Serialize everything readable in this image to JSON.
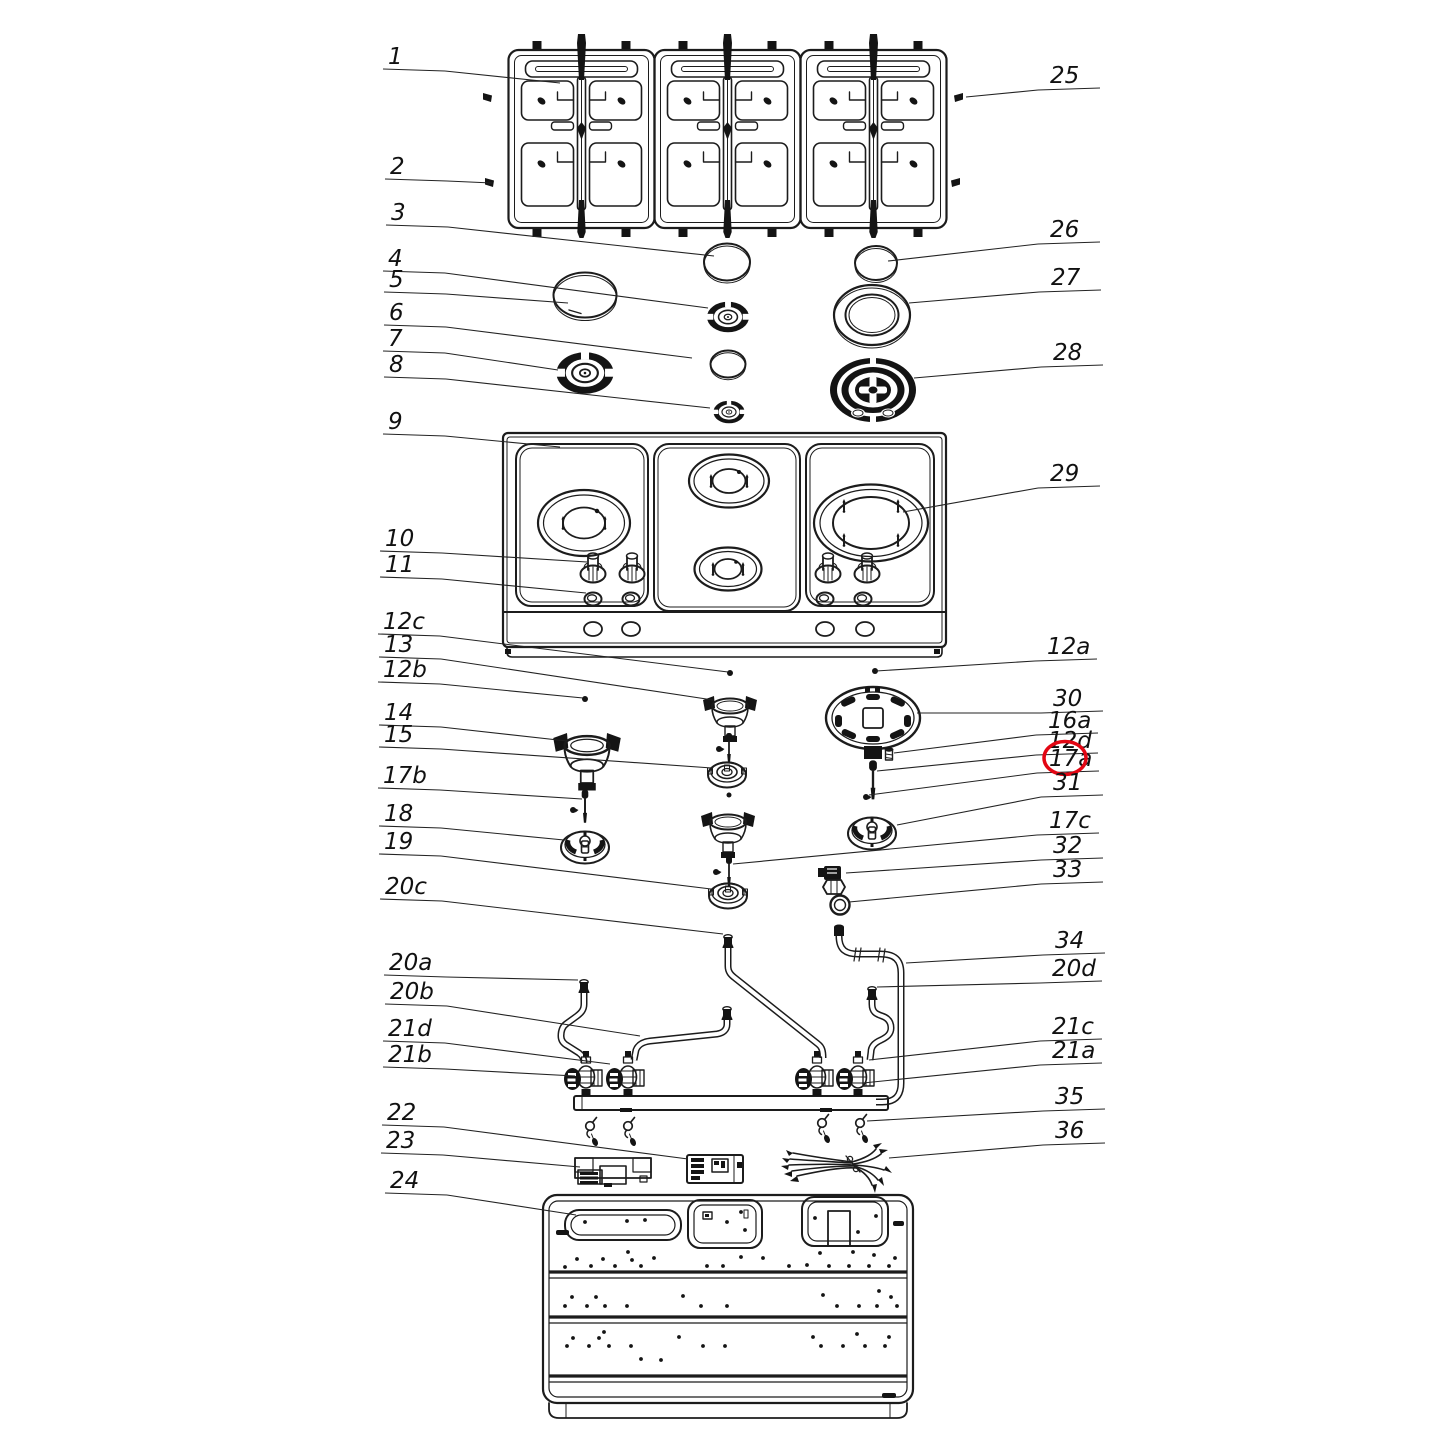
{
  "diagram": {
    "type": "exploded-parts-diagram",
    "subject": "gas-cooktop",
    "line_color": "#1c1c1c",
    "highlight_color": "#e30613",
    "highlighted_part": "17a",
    "labels": [
      {
        "id": "1",
        "text": "1",
        "side": "left",
        "x": 388,
        "y": 64,
        "tx": 560,
        "ty": 83
      },
      {
        "id": "2",
        "text": "2",
        "side": "left",
        "x": 390,
        "y": 174,
        "tx": 492,
        "ty": 183
      },
      {
        "id": "3",
        "text": "3",
        "side": "left",
        "x": 391,
        "y": 220,
        "tx": 714,
        "ty": 256
      },
      {
        "id": "4",
        "text": "4",
        "side": "left",
        "x": 388,
        "y": 266,
        "tx": 708,
        "ty": 308
      },
      {
        "id": "5",
        "text": "5",
        "side": "left",
        "x": 389,
        "y": 287,
        "tx": 568,
        "ty": 303
      },
      {
        "id": "6",
        "text": "6",
        "side": "left",
        "x": 389,
        "y": 320,
        "tx": 692,
        "ty": 358
      },
      {
        "id": "7",
        "text": "7",
        "side": "left",
        "x": 388,
        "y": 346,
        "tx": 558,
        "ty": 370
      },
      {
        "id": "8",
        "text": "8",
        "side": "left",
        "x": 389,
        "y": 372,
        "tx": 710,
        "ty": 408
      },
      {
        "id": "9",
        "text": "9",
        "side": "left",
        "x": 388,
        "y": 429,
        "tx": 560,
        "ty": 447
      },
      {
        "id": "10",
        "text": "10",
        "side": "left",
        "x": 385,
        "y": 546,
        "tx": 587,
        "ty": 562
      },
      {
        "id": "11",
        "text": "11",
        "side": "left",
        "x": 385,
        "y": 572,
        "tx": 586,
        "ty": 593
      },
      {
        "id": "12c",
        "text": "12c",
        "side": "left",
        "x": 383,
        "y": 629,
        "tx": 728,
        "ty": 672
      },
      {
        "id": "13",
        "text": "13",
        "side": "left",
        "x": 384,
        "y": 652,
        "tx": 713,
        "ty": 700
      },
      {
        "id": "12b",
        "text": "12b",
        "side": "left",
        "x": 383,
        "y": 677,
        "tx": 583,
        "ty": 698
      },
      {
        "id": "14",
        "text": "14",
        "side": "left",
        "x": 384,
        "y": 720,
        "tx": 567,
        "ty": 741
      },
      {
        "id": "15",
        "text": "15",
        "side": "left",
        "x": 384,
        "y": 742,
        "tx": 712,
        "ty": 768
      },
      {
        "id": "17b",
        "text": "17b",
        "side": "left",
        "x": 383,
        "y": 783,
        "tx": 582,
        "ty": 799
      },
      {
        "id": "18",
        "text": "18",
        "side": "left",
        "x": 384,
        "y": 821,
        "tx": 564,
        "ty": 840
      },
      {
        "id": "19",
        "text": "19",
        "side": "left",
        "x": 384,
        "y": 849,
        "tx": 711,
        "ty": 889
      },
      {
        "id": "20c",
        "text": "20c",
        "side": "left",
        "x": 385,
        "y": 894,
        "tx": 723,
        "ty": 934
      },
      {
        "id": "20a",
        "text": "20a",
        "side": "left",
        "x": 389,
        "y": 970,
        "tx": 578,
        "ty": 980
      },
      {
        "id": "20b",
        "text": "20b",
        "side": "left",
        "x": 390,
        "y": 999,
        "tx": 640,
        "ty": 1036
      },
      {
        "id": "21d",
        "text": "21d",
        "side": "left",
        "x": 388,
        "y": 1036,
        "tx": 610,
        "ty": 1064
      },
      {
        "id": "21b",
        "text": "21b",
        "side": "left",
        "x": 388,
        "y": 1062,
        "tx": 575,
        "ty": 1076
      },
      {
        "id": "22",
        "text": "22",
        "side": "left",
        "x": 387,
        "y": 1120,
        "tx": 688,
        "ty": 1159
      },
      {
        "id": "23",
        "text": "23",
        "side": "left",
        "x": 386,
        "y": 1148,
        "tx": 580,
        "ty": 1167
      },
      {
        "id": "24",
        "text": "24",
        "side": "left",
        "x": 390,
        "y": 1188,
        "tx": 576,
        "ty": 1215
      },
      {
        "id": "25",
        "text": "25",
        "side": "right",
        "x": 1050,
        "y": 83,
        "tx": 966,
        "ty": 97
      },
      {
        "id": "26",
        "text": "26",
        "side": "right",
        "x": 1050,
        "y": 237,
        "tx": 888,
        "ty": 261
      },
      {
        "id": "27",
        "text": "27",
        "side": "right",
        "x": 1051,
        "y": 285,
        "tx": 909,
        "ty": 303
      },
      {
        "id": "28",
        "text": "28",
        "side": "right",
        "x": 1053,
        "y": 360,
        "tx": 914,
        "ty": 378
      },
      {
        "id": "29",
        "text": "29",
        "side": "right",
        "x": 1050,
        "y": 481,
        "tx": 903,
        "ty": 512
      },
      {
        "id": "12a",
        "text": "12a",
        "side": "right",
        "x": 1047,
        "y": 654,
        "tx": 876,
        "ty": 671
      },
      {
        "id": "30",
        "text": "30",
        "side": "right",
        "x": 1053,
        "y": 706,
        "tx": 917,
        "ty": 713
      },
      {
        "id": "16a",
        "text": "16a",
        "side": "right",
        "x": 1048,
        "y": 728,
        "tx": 894,
        "ty": 753
      },
      {
        "id": "12d",
        "text": "12d",
        "side": "right",
        "x": 1048,
        "y": 748,
        "tx": 877,
        "ty": 771
      },
      {
        "id": "17a",
        "text": "17a",
        "side": "right",
        "x": 1049,
        "y": 766,
        "tx": 869,
        "ty": 795,
        "circled": true
      },
      {
        "id": "31",
        "text": "31",
        "side": "right",
        "x": 1053,
        "y": 790,
        "tx": 897,
        "ty": 825
      },
      {
        "id": "17c",
        "text": "17c",
        "side": "right",
        "x": 1049,
        "y": 828,
        "tx": 733,
        "ty": 864
      },
      {
        "id": "32",
        "text": "32",
        "side": "right",
        "x": 1053,
        "y": 853,
        "tx": 846,
        "ty": 873
      },
      {
        "id": "33",
        "text": "33",
        "side": "right",
        "x": 1053,
        "y": 877,
        "tx": 849,
        "ty": 902
      },
      {
        "id": "34",
        "text": "34",
        "side": "right",
        "x": 1055,
        "y": 948,
        "tx": 906,
        "ty": 963
      },
      {
        "id": "20d",
        "text": "20d",
        "side": "right",
        "x": 1052,
        "y": 976,
        "tx": 877,
        "ty": 987
      },
      {
        "id": "21c",
        "text": "21c",
        "side": "right",
        "x": 1052,
        "y": 1034,
        "tx": 869,
        "ty": 1060
      },
      {
        "id": "21a",
        "text": "21a",
        "side": "right",
        "x": 1052,
        "y": 1058,
        "tx": 863,
        "ty": 1083
      },
      {
        "id": "35",
        "text": "35",
        "side": "right",
        "x": 1055,
        "y": 1104,
        "tx": 867,
        "ty": 1121
      },
      {
        "id": "36",
        "text": "36",
        "side": "right",
        "x": 1055,
        "y": 1138,
        "tx": 889,
        "ty": 1158
      }
    ]
  }
}
